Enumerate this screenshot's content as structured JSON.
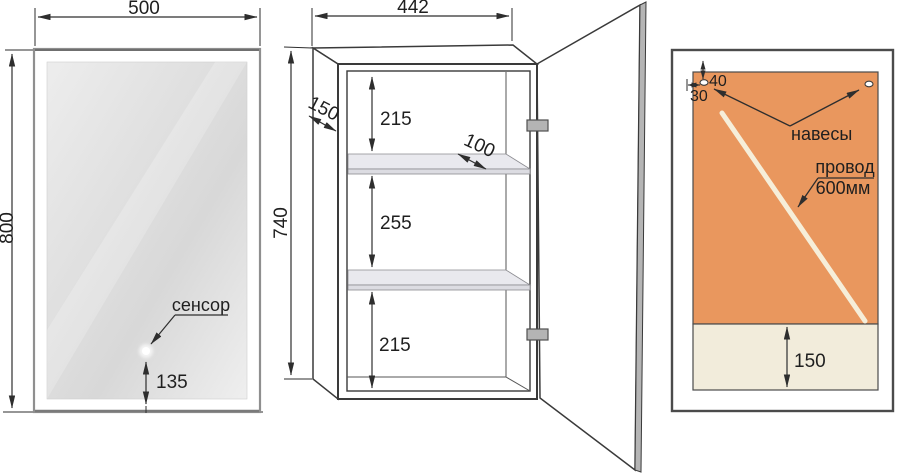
{
  "front_view": {
    "width": "500",
    "height": "800",
    "sensor_label": "сенсор",
    "sensor_offset": "135"
  },
  "cabinet_view": {
    "width": "442",
    "height": "740",
    "depth": "150",
    "shelf_depth": "100",
    "sections": [
      "215",
      "255",
      "215"
    ]
  },
  "back_view": {
    "hanger_top_offset": "40",
    "hanger_side_offset": "30",
    "hangers_label": "навесы",
    "wire_label": "провод",
    "wire_length": "600мм",
    "bottom_height": "150"
  },
  "colors": {
    "line": "#2e2e2e",
    "back_panel_orange": "#e9975e",
    "bottom_panel_cream": "#f2ecdb",
    "wire": "#f6eed9",
    "shelf_top": "#e9e9ee",
    "shelf_front": "#dcdce2",
    "door_edge": "#b5b5b5",
    "hinge": "#b4b4b4",
    "mirror_frame": "#8f8f8f"
  }
}
